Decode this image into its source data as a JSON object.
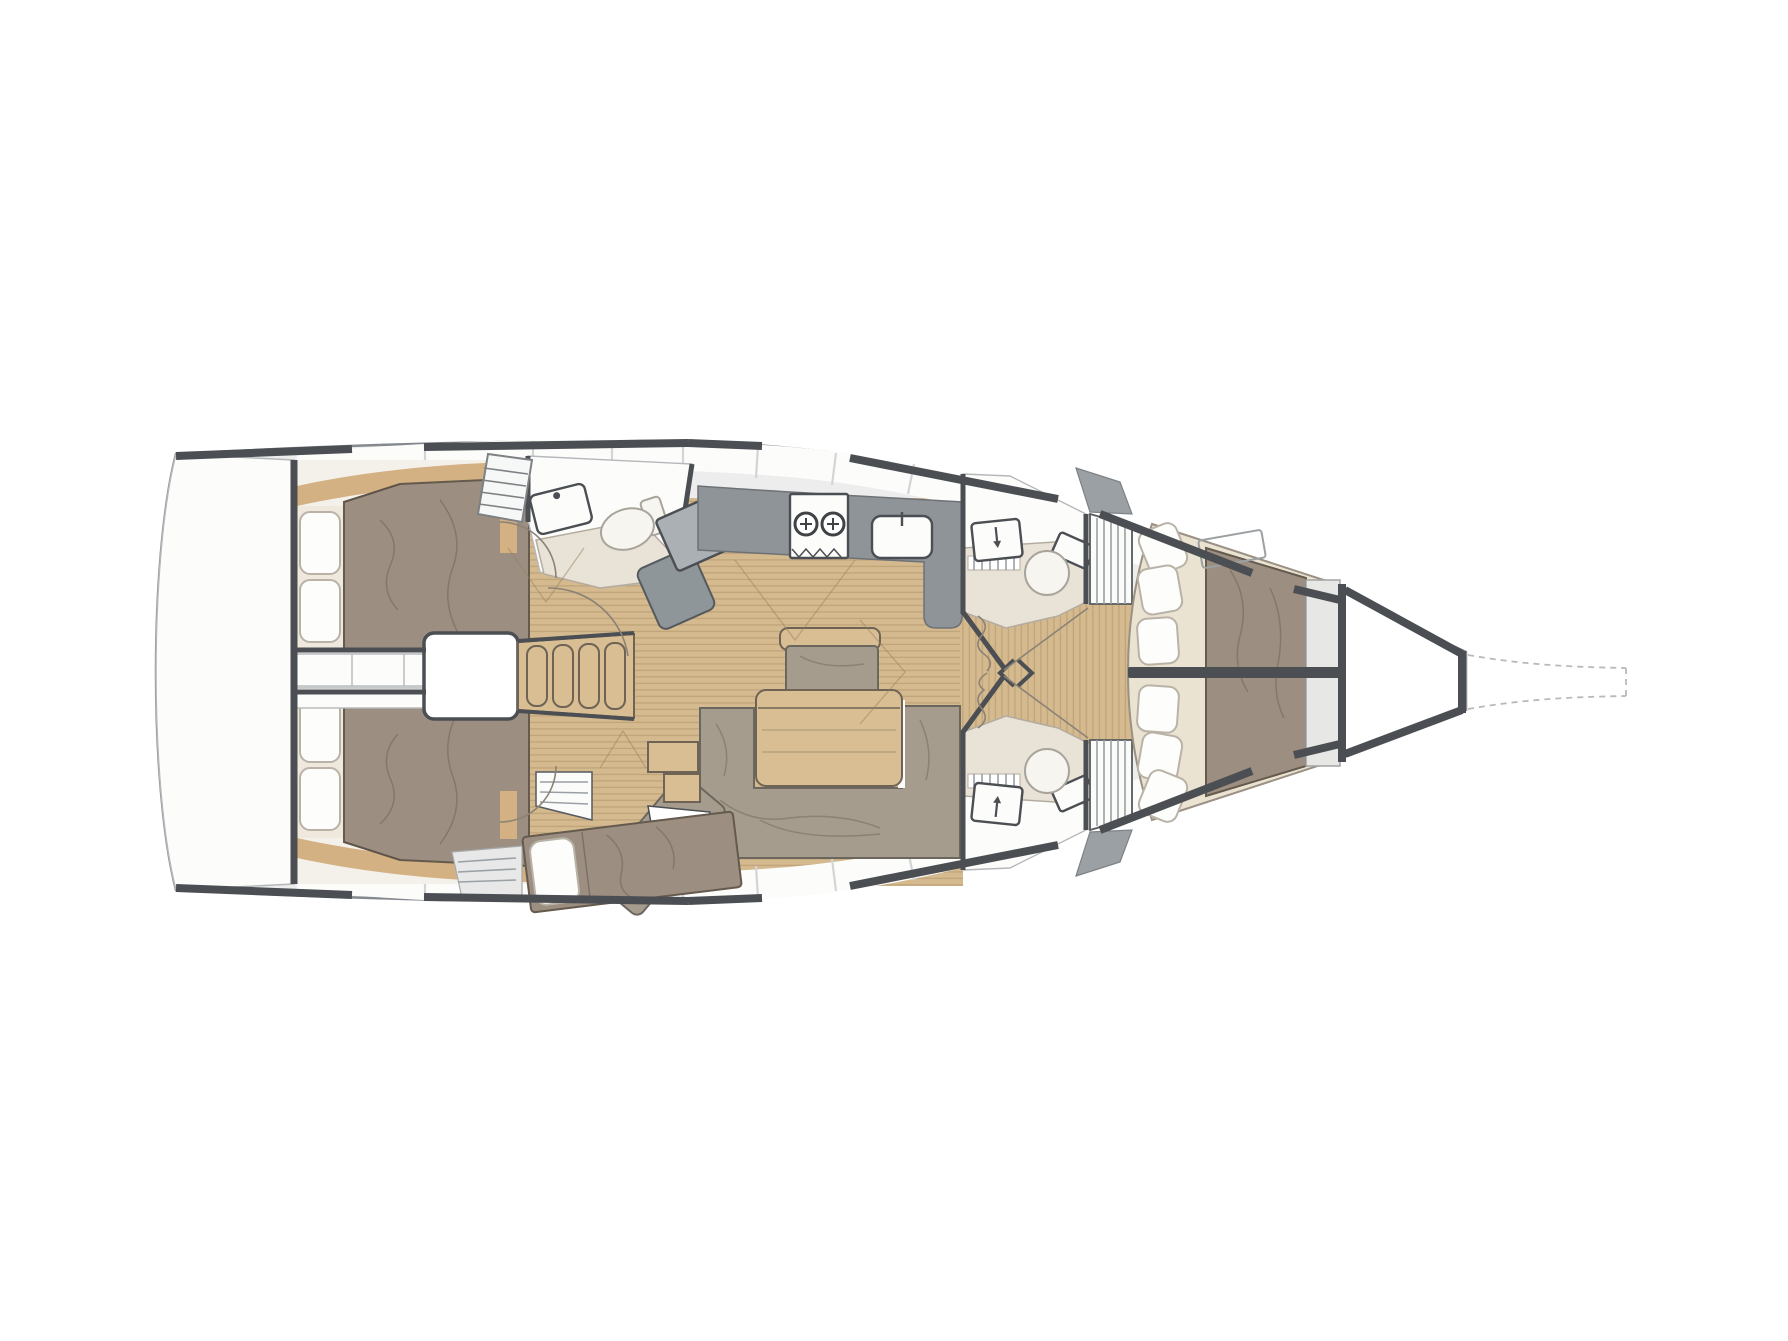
{
  "page": {
    "description": "Top-down interior layout plan of a sailing yacht, bow pointing right: two aft double cabins, companionway with engine box, aft head, chart table, port galley, saloon with L-shaped sofa and table, single berth, two forward heads with hanging lockers, forward owner's cabin with V-berth, anchor locker and dashed bow outline"
  },
  "colors": {
    "deck": "#ecedec",
    "hull_line": "#85898d",
    "white": "#fcfcfb",
    "wall": "#4b4e52",
    "room_line": "#b5b8ba",
    "divider": "#d2d4d5",
    "wood_floor": "#d5ba8f",
    "wood_seam": "#c1a67c",
    "wood_furniture": "#d8be92",
    "wood_trim": "#d3b183",
    "wood_edge": "#6f6356",
    "bed": "#9c8e80",
    "bed_edge": "#645a4e",
    "upholstery": "#a59c8d",
    "pillow": "#fdfdfc",
    "pillow_edge": "#b9b3a7",
    "cream": "#ebe3d2",
    "cream_edge": "#9a9083",
    "shower": "#e9e2d6",
    "shower_edge": "#b5aca0",
    "counter": "#8e9498",
    "counter_edge": "#6e7276",
    "counter_light": "#abb0b4",
    "cabinet_gray": "#9aa0a4",
    "berth_bg": "#f4f1ea",
    "arc": "#8b8276",
    "dash": "#b9b9b9"
  },
  "regions": [
    {
      "name": "transom-platform",
      "label": "Stern platform"
    },
    {
      "name": "port-aft-cabin",
      "label": "Aft double cabin (port)"
    },
    {
      "name": "starboard-aft-cabin",
      "label": "Aft double cabin (starboard)"
    },
    {
      "name": "engine-compartment",
      "label": "Engine box"
    },
    {
      "name": "companionway-steps",
      "label": "Companionway steps"
    },
    {
      "name": "aft-head",
      "label": "Aft head with shower"
    },
    {
      "name": "chart-table",
      "label": "Chart table and seat"
    },
    {
      "name": "galley",
      "label": "L-shaped galley with stove and sink"
    },
    {
      "name": "saloon",
      "label": "Saloon"
    },
    {
      "name": "saloon-table",
      "label": "Saloon table with bench"
    },
    {
      "name": "saloon-sofa",
      "label": "L-shaped sofa with chaise"
    },
    {
      "name": "single-berth",
      "label": "Single berth"
    },
    {
      "name": "forward-head-port",
      "label": "Forward head (port)"
    },
    {
      "name": "forward-head-starboard",
      "label": "Forward head (starboard)"
    },
    {
      "name": "hanging-lockers",
      "label": "Hanging lockers"
    },
    {
      "name": "owner-cabin",
      "label": "Forward owner's cabin with V-berth"
    },
    {
      "name": "anchor-locker",
      "label": "Anchor locker"
    },
    {
      "name": "bow-outline",
      "label": "Dashed bow / bowsprit outline"
    }
  ]
}
